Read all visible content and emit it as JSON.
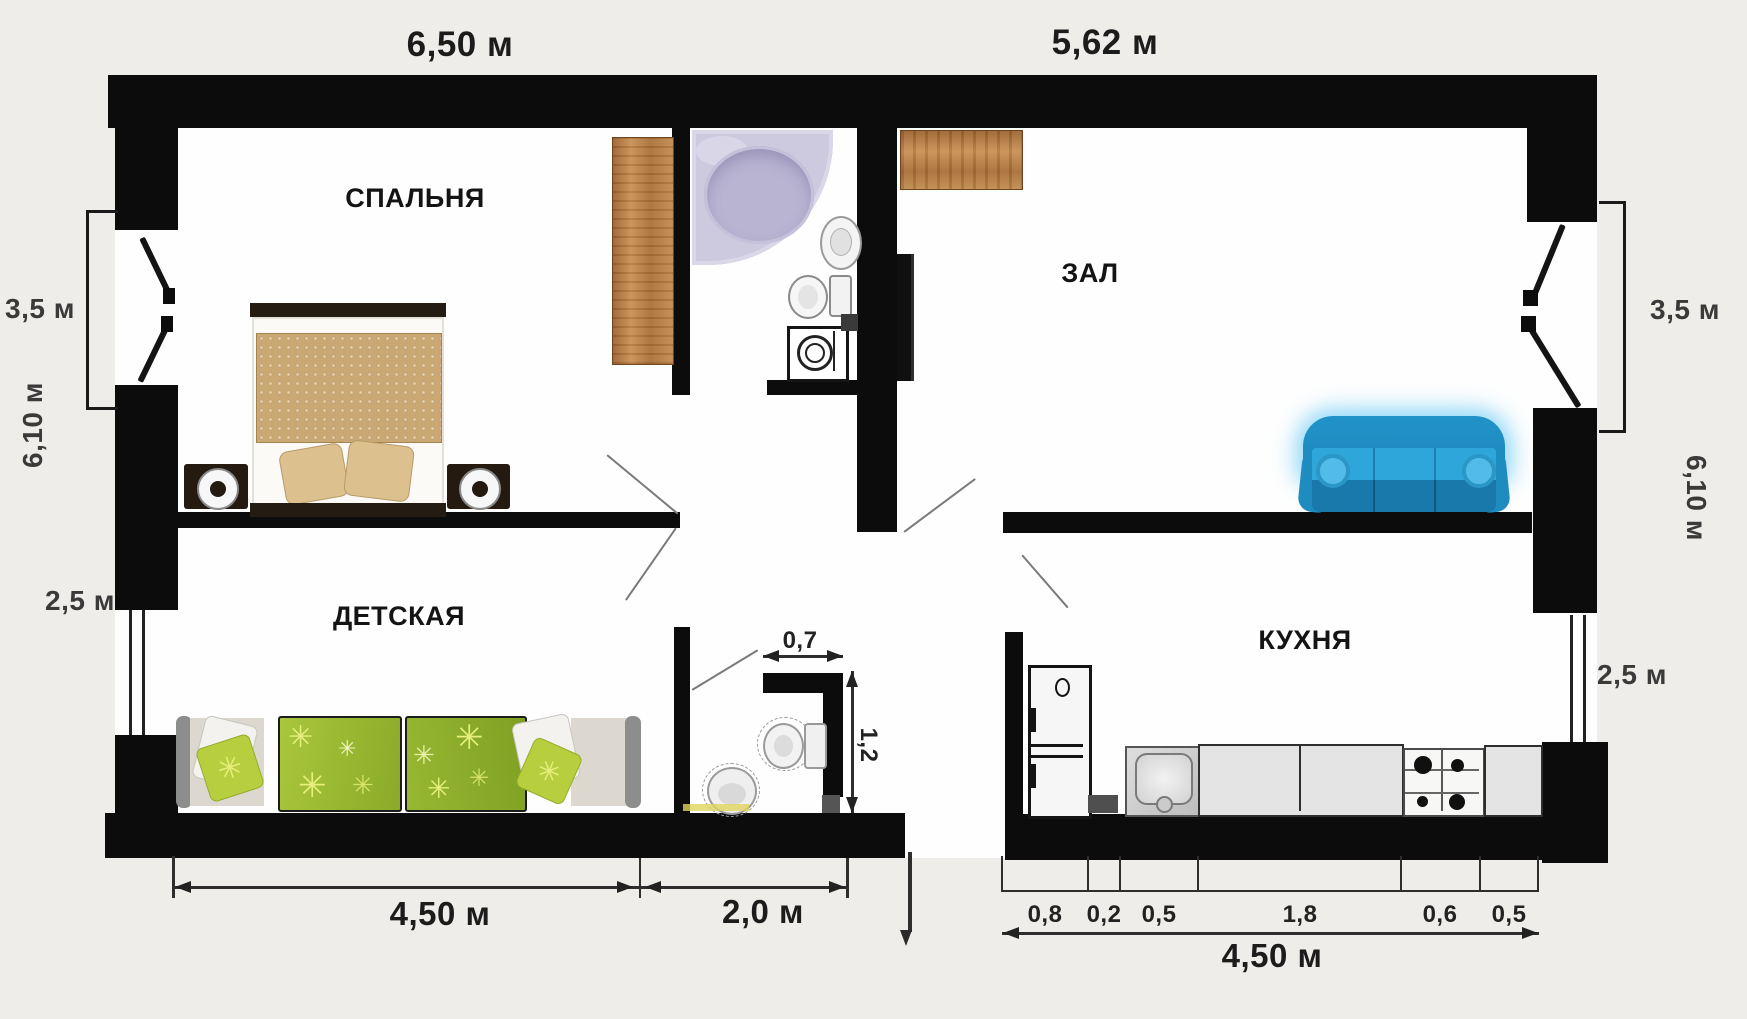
{
  "plan": {
    "rooms": {
      "bedroom": "СПАЛЬНЯ",
      "living": "ЗАЛ",
      "kids": "ДЕТСКАЯ",
      "kitchen": "КУХНЯ"
    },
    "dims": {
      "top_left": "6,50 м",
      "top_right": "5,62 м",
      "left_balcony": "3,5 м",
      "left_side": "6,10 м",
      "left_window": "2,5 м",
      "right_balcony": "3,5 м",
      "right_side": "6,10 м",
      "right_window": "2,5 м",
      "kids_width": "4,50 м",
      "hall_width": "2,0 м",
      "wc_width": "0,7",
      "wc_depth": "1,2",
      "kitchen_total": "4,50 м",
      "kitchen_segments": [
        "0,8",
        "0,2",
        "0,5",
        "1,8",
        "0,6",
        "0,5"
      ]
    },
    "decor": {
      "star": "✳"
    },
    "furniture": {
      "bedroom": [
        "double-bed",
        "nightstand-left",
        "nightstand-right",
        "wardrobe"
      ],
      "bathroom": [
        "corner-bathtub",
        "washbasin",
        "toilet",
        "washing-machine"
      ],
      "living": [
        "dresser",
        "tv",
        "sofa"
      ],
      "kids": [
        "single-bed-left",
        "single-bed-right"
      ],
      "wc": [
        "toilet",
        "washbasin"
      ],
      "kitchen": [
        "fridge",
        "sink",
        "counter",
        "stove",
        "counter-end"
      ]
    },
    "colors": {
      "wall": "#0c0c0c",
      "background": "#efedea",
      "floor": "#fefefe",
      "wood": "#b5763f",
      "sofa_blue": "#2b9fd4",
      "bathtub_lavender": "#c9c5dc",
      "kids_blanket_green": "#93b32c",
      "bed_blanket_tan": "#c7a671"
    }
  }
}
